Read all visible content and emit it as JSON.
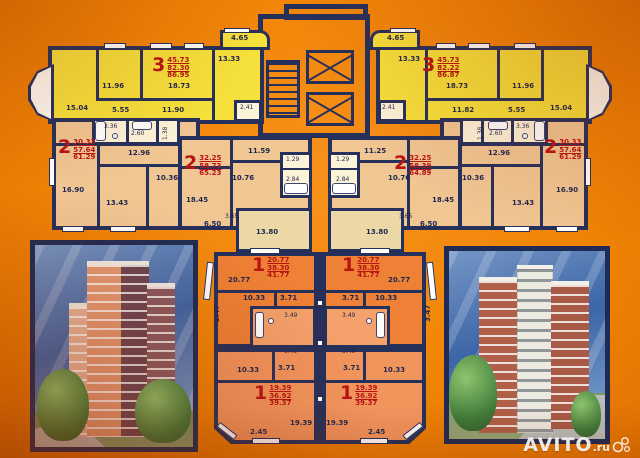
{
  "watermark": {
    "brand": "AVITO",
    "tld": ".ru"
  },
  "colors": {
    "background_orange": "#f08406",
    "wall_navy": "#25305b",
    "apartment3_yellow": "#f6e13c",
    "apartment2_tan": "#f0c693",
    "room_cream": "#ecd8a6",
    "apartment1_orange": "#ee8135",
    "apartment1_salmon": "#f2955d",
    "bath_light": "#fdf3d8",
    "area_text_red": "#b81414"
  },
  "floorplan": {
    "apartments": [
      {
        "id": "apt-3-left",
        "num": "3",
        "v1": "45.73",
        "v2": "82.30",
        "v3": "86.95",
        "x": 152,
        "y": 56
      },
      {
        "id": "apt-3-right",
        "num": "3",
        "v1": "45.73",
        "v2": "82.22",
        "v3": "86.87",
        "x": 422,
        "y": 56
      },
      {
        "id": "apt-2-left",
        "num": "2",
        "v1": "30.33",
        "v2": "57.64",
        "v3": "61.29",
        "x": 58,
        "y": 138
      },
      {
        "id": "apt-2-right",
        "num": "2",
        "v1": "30.33",
        "v2": "57.64",
        "v3": "61.29",
        "x": 544,
        "y": 138
      },
      {
        "id": "apt-2-center-left",
        "num": "2",
        "v1": "32.25",
        "v2": "58.73",
        "v3": "65.23",
        "x": 184,
        "y": 154
      },
      {
        "id": "apt-2-center-right",
        "num": "2",
        "v1": "32.25",
        "v2": "58.39",
        "v3": "64.89",
        "x": 394,
        "y": 154
      },
      {
        "id": "apt-1-upper-left",
        "num": "1",
        "v1": "20.77",
        "v2": "38.30",
        "v3": "41.77",
        "x": 252,
        "y": 256
      },
      {
        "id": "apt-1-upper-right",
        "num": "1",
        "v1": "20.77",
        "v2": "38.30",
        "v3": "41.77",
        "x": 342,
        "y": 256
      },
      {
        "id": "apt-1-lower-left",
        "num": "1",
        "v1": "19.39",
        "v2": "36.92",
        "v3": "39.37",
        "x": 254,
        "y": 384
      },
      {
        "id": "apt-1-lower-right",
        "num": "1",
        "v1": "19.39",
        "v2": "36.92",
        "v3": "39.37",
        "x": 340,
        "y": 384
      }
    ],
    "labels": [
      {
        "t": "15.04",
        "x": 66,
        "y": 104
      },
      {
        "t": "11.96",
        "x": 102,
        "y": 82
      },
      {
        "t": "18.73",
        "x": 168,
        "y": 82
      },
      {
        "t": "5.55",
        "x": 112,
        "y": 106
      },
      {
        "t": "11.90",
        "x": 162,
        "y": 106
      },
      {
        "t": "13.33",
        "x": 218,
        "y": 55
      },
      {
        "t": "4.65",
        "x": 231,
        "y": 34
      },
      {
        "t": "2.41",
        "x": 240,
        "y": 104,
        "s": "tiny"
      },
      {
        "t": "4.65",
        "x": 387,
        "y": 34
      },
      {
        "t": "13.33",
        "x": 398,
        "y": 55
      },
      {
        "t": "18.73",
        "x": 446,
        "y": 82
      },
      {
        "t": "11.96",
        "x": 512,
        "y": 82
      },
      {
        "t": "11.82",
        "x": 452,
        "y": 106
      },
      {
        "t": "5.55",
        "x": 508,
        "y": 106
      },
      {
        "t": "15.04",
        "x": 550,
        "y": 104
      },
      {
        "t": "2.41",
        "x": 382,
        "y": 104,
        "s": "tiny"
      },
      {
        "t": "16.90",
        "x": 62,
        "y": 186
      },
      {
        "t": "12.96",
        "x": 128,
        "y": 149
      },
      {
        "t": "10.36",
        "x": 156,
        "y": 174
      },
      {
        "t": "13.43",
        "x": 106,
        "y": 199
      },
      {
        "t": "3.36",
        "x": 104,
        "y": 123,
        "s": "tiny"
      },
      {
        "t": "2.60",
        "x": 131,
        "y": 130,
        "s": "tiny"
      },
      {
        "t": "1.38",
        "x": 162,
        "y": 140,
        "s": "tiny rot"
      },
      {
        "t": "16.90",
        "x": 556,
        "y": 186
      },
      {
        "t": "12.96",
        "x": 488,
        "y": 149
      },
      {
        "t": "10.36",
        "x": 462,
        "y": 174
      },
      {
        "t": "13.43",
        "x": 512,
        "y": 199
      },
      {
        "t": "3.36",
        "x": 516,
        "y": 123,
        "s": "tiny"
      },
      {
        "t": "2.60",
        "x": 489,
        "y": 130,
        "s": "tiny"
      },
      {
        "t": "1.38",
        "x": 477,
        "y": 140,
        "s": "tiny rot"
      },
      {
        "t": "11.59",
        "x": 248,
        "y": 147
      },
      {
        "t": "10.76",
        "x": 232,
        "y": 174
      },
      {
        "t": "18.45",
        "x": 186,
        "y": 196
      },
      {
        "t": "6.50",
        "x": 204,
        "y": 220
      },
      {
        "t": "3.65",
        "x": 225,
        "y": 213,
        "s": "tiny"
      },
      {
        "t": "13.80",
        "x": 256,
        "y": 228
      },
      {
        "t": "1.29",
        "x": 286,
        "y": 156,
        "s": "tiny"
      },
      {
        "t": "2.84",
        "x": 286,
        "y": 176,
        "s": "tiny"
      },
      {
        "t": "11.25",
        "x": 364,
        "y": 147
      },
      {
        "t": "10.76",
        "x": 388,
        "y": 174
      },
      {
        "t": "18.45",
        "x": 432,
        "y": 196
      },
      {
        "t": "6.50",
        "x": 420,
        "y": 220
      },
      {
        "t": "3.65",
        "x": 399,
        "y": 213,
        "s": "tiny"
      },
      {
        "t": "13.80",
        "x": 366,
        "y": 228
      },
      {
        "t": "1.29",
        "x": 336,
        "y": 156,
        "s": "tiny"
      },
      {
        "t": "2.84",
        "x": 336,
        "y": 176,
        "s": "tiny"
      },
      {
        "t": "20.77",
        "x": 228,
        "y": 276
      },
      {
        "t": "10.33",
        "x": 243,
        "y": 294
      },
      {
        "t": "3.71",
        "x": 280,
        "y": 294
      },
      {
        "t": "3.47",
        "x": 213,
        "y": 322,
        "s": "rot"
      },
      {
        "t": "3.49",
        "x": 284,
        "y": 312,
        "s": "tiny"
      },
      {
        "t": "20.77",
        "x": 388,
        "y": 276
      },
      {
        "t": "10.33",
        "x": 375,
        "y": 294
      },
      {
        "t": "3.71",
        "x": 342,
        "y": 294
      },
      {
        "t": "3.47",
        "x": 424,
        "y": 322,
        "s": "rot"
      },
      {
        "t": "3.49",
        "x": 342,
        "y": 312,
        "s": "tiny"
      },
      {
        "t": "3.49",
        "x": 284,
        "y": 348,
        "s": "tiny"
      },
      {
        "t": "10.33",
        "x": 237,
        "y": 366
      },
      {
        "t": "3.71",
        "x": 278,
        "y": 364
      },
      {
        "t": "19.39",
        "x": 290,
        "y": 419
      },
      {
        "t": "2.45",
        "x": 250,
        "y": 428
      },
      {
        "t": "3.49",
        "x": 342,
        "y": 348,
        "s": "tiny"
      },
      {
        "t": "10.33",
        "x": 383,
        "y": 366
      },
      {
        "t": "3.71",
        "x": 343,
        "y": 364
      },
      {
        "t": "19.39",
        "x": 326,
        "y": 419
      },
      {
        "t": "2.45",
        "x": 368,
        "y": 428
      }
    ]
  }
}
